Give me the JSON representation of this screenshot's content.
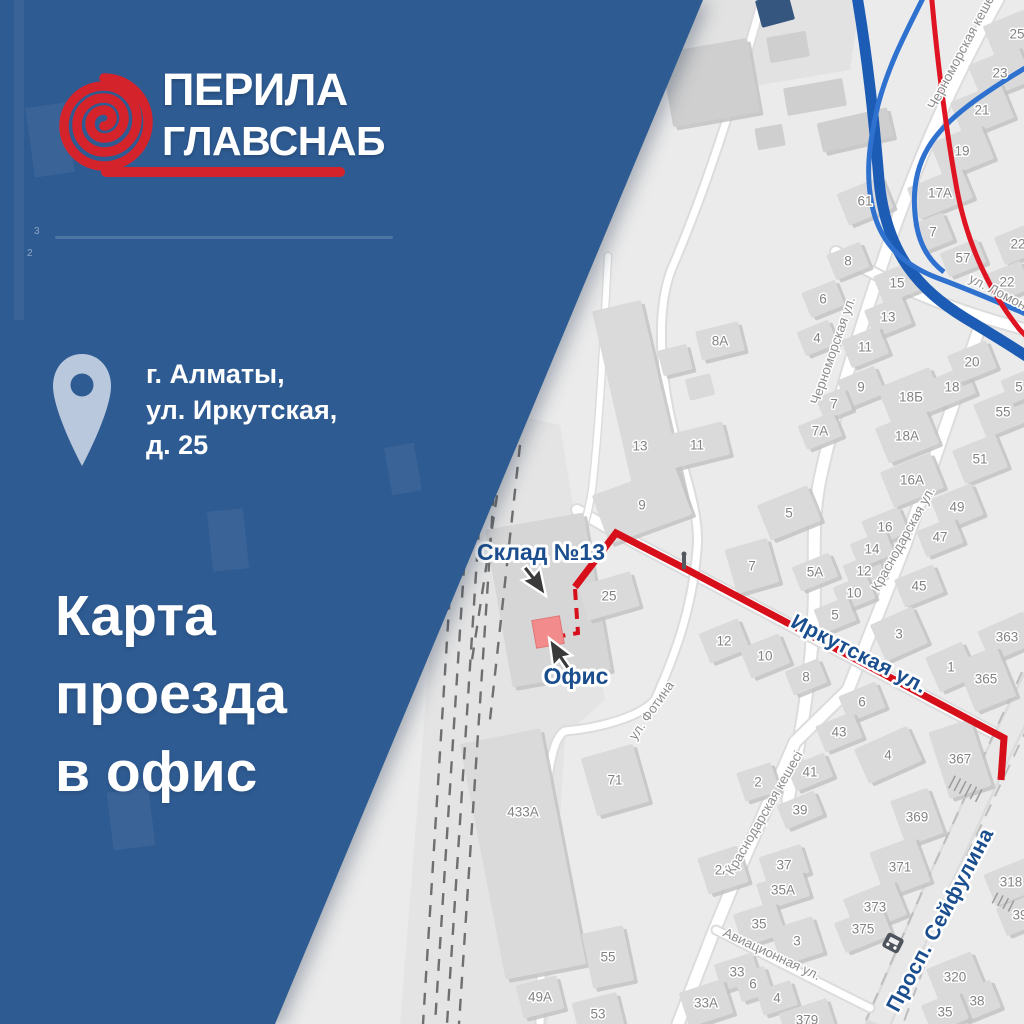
{
  "panel": {
    "brand": {
      "line1": "ПЕРИЛА",
      "line2": "ГЛАВСНАБ"
    },
    "address": {
      "lines": [
        "г. Алматы,",
        "ул. Иркутская,",
        "д. 25"
      ]
    },
    "title": {
      "lines": [
        "Карта",
        "проезда",
        "в офис"
      ]
    }
  },
  "map": {
    "callouts": {
      "warehouse": "Склад №13",
      "office": "Офис"
    },
    "ghost_labels": [
      {
        "t": "3"
      },
      {
        "t": "2"
      }
    ],
    "street_labels": [
      {
        "name": "Черноморская кешесі",
        "x": 967,
        "y": 50,
        "r": -62
      },
      {
        "name": "Черноморская ул.",
        "x": 837,
        "y": 352,
        "r": -71
      },
      {
        "name": "ул. Ломоносова",
        "x": 1012,
        "y": 304,
        "r": 27
      },
      {
        "name": "Краснодарская ул.",
        "x": 907,
        "y": 541,
        "r": -61
      },
      {
        "name": "Краснодарская кешесі",
        "x": 768,
        "y": 815,
        "r": -60
      },
      {
        "name": "ул. Фотина",
        "x": 655,
        "y": 713,
        "r": -55
      },
      {
        "name": "Авиационная ул.",
        "x": 770,
        "y": 958,
        "r": 25
      },
      {
        "name": "Иркутская ул.",
        "x": 856,
        "y": 660,
        "r": 27,
        "major": true
      },
      {
        "name": "Просп. Сейфулина",
        "x": 946,
        "y": 923,
        "r": -62,
        "major": true
      }
    ],
    "building_labels": [
      {
        "t": "25",
        "x": 1017,
        "y": 34,
        "w": 58,
        "h": 40
      },
      {
        "t": "23",
        "x": 1000,
        "y": 73,
        "w": 54,
        "h": 38
      },
      {
        "t": "21",
        "x": 982,
        "y": 110,
        "w": 54,
        "h": 38
      },
      {
        "t": "19",
        "x": 962,
        "y": 151,
        "w": 54,
        "h": 38
      },
      {
        "t": "17А",
        "x": 940,
        "y": 193,
        "w": 58,
        "h": 34
      },
      {
        "t": "7",
        "x": 933,
        "y": 232,
        "w": 32,
        "h": 30
      },
      {
        "t": "57",
        "x": 963,
        "y": 258,
        "w": 40,
        "h": 26
      },
      {
        "t": "22",
        "x": 1018,
        "y": 244,
        "w": 40,
        "h": 30
      },
      {
        "t": "22",
        "x": 1007,
        "y": 282,
        "w": 40,
        "h": 30
      },
      {
        "t": "61",
        "x": 865,
        "y": 201,
        "w": 48,
        "h": 34
      },
      {
        "t": "8",
        "x": 848,
        "y": 261,
        "w": 36,
        "h": 27
      },
      {
        "t": "6",
        "x": 823,
        "y": 299,
        "w": 36,
        "h": 27
      },
      {
        "t": "15",
        "x": 897,
        "y": 283,
        "w": 40,
        "h": 30
      },
      {
        "t": "13",
        "x": 888,
        "y": 317,
        "w": 40,
        "h": 30
      },
      {
        "t": "11",
        "x": 865,
        "y": 347,
        "w": 40,
        "h": 30
      },
      {
        "t": "9",
        "x": 861,
        "y": 387,
        "w": 40,
        "h": 30
      },
      {
        "t": "4",
        "x": 817,
        "y": 338,
        "w": 34,
        "h": 26
      },
      {
        "t": "7",
        "x": 834,
        "y": 404,
        "w": 30,
        "h": 24
      },
      {
        "t": "7А",
        "x": 820,
        "y": 431,
        "w": 38,
        "h": 26
      },
      {
        "t": "5",
        "x": 789,
        "y": 513,
        "w": 54,
        "h": 38
      },
      {
        "t": "8А",
        "x": 720,
        "y": 341,
        "w": 44,
        "h": 30,
        "r": -14
      },
      {
        "t": "13",
        "x": 640,
        "y": 446,
        "w": 50,
        "h": 210,
        "r": -13,
        "dy": -38
      },
      {
        "t": "11",
        "x": 697,
        "y": 445,
        "w": 60,
        "h": 34,
        "r": -14
      },
      {
        "t": "9",
        "x": 642,
        "y": 505,
        "w": 88,
        "h": 52,
        "r": -20
      },
      {
        "t": "25",
        "x": 609,
        "y": 596,
        "w": 54,
        "h": 36,
        "r": -16
      },
      {
        "t": "7",
        "x": 752,
        "y": 566,
        "w": 44,
        "h": 46,
        "r": -16
      },
      {
        "t": "5А",
        "x": 815,
        "y": 572,
        "w": 40,
        "h": 26
      },
      {
        "t": "12",
        "x": 724,
        "y": 641,
        "w": 42,
        "h": 32
      },
      {
        "t": "10",
        "x": 765,
        "y": 656,
        "w": 42,
        "h": 32
      },
      {
        "t": "8",
        "x": 806,
        "y": 677,
        "w": 36,
        "h": 26
      },
      {
        "t": "12",
        "x": 864,
        "y": 571,
        "w": 36,
        "h": 26
      },
      {
        "t": "10",
        "x": 854,
        "y": 593,
        "w": 36,
        "h": 26
      },
      {
        "t": "5",
        "x": 835,
        "y": 615,
        "w": 36,
        "h": 26
      },
      {
        "t": "45",
        "x": 919,
        "y": 586,
        "w": 42,
        "h": 30
      },
      {
        "t": "3",
        "x": 899,
        "y": 634,
        "w": 46,
        "h": 40,
        "r": -24
      },
      {
        "t": "1",
        "x": 951,
        "y": 667,
        "w": 40,
        "h": 38,
        "r": -24
      },
      {
        "t": "363",
        "x": 1007,
        "y": 637,
        "w": 50,
        "h": 34,
        "r": -24
      },
      {
        "t": "365",
        "x": 986,
        "y": 679,
        "w": 44,
        "h": 54,
        "r": -22
      },
      {
        "t": "6",
        "x": 862,
        "y": 702,
        "w": 40,
        "h": 28
      },
      {
        "t": "2",
        "x": 758,
        "y": 782,
        "w": 36,
        "h": 30,
        "r": -18
      },
      {
        "t": "43",
        "x": 839,
        "y": 732,
        "w": 40,
        "h": 28
      },
      {
        "t": "4",
        "x": 888,
        "y": 755,
        "w": 58,
        "h": 38,
        "r": -24
      },
      {
        "t": "367",
        "x": 960,
        "y": 759,
        "w": 44,
        "h": 70,
        "r": -18
      },
      {
        "t": "41",
        "x": 810,
        "y": 772,
        "w": 40,
        "h": 26
      },
      {
        "t": "39",
        "x": 800,
        "y": 810,
        "w": 40,
        "h": 26
      },
      {
        "t": "369",
        "x": 917,
        "y": 817,
        "w": 40,
        "h": 48,
        "r": -20
      },
      {
        "t": "371",
        "x": 900,
        "y": 867,
        "w": 48,
        "h": 48,
        "r": -20
      },
      {
        "t": "373",
        "x": 875,
        "y": 907,
        "w": 54,
        "h": 38,
        "r": -22
      },
      {
        "t": "375",
        "x": 863,
        "y": 929,
        "w": 50,
        "h": 32,
        "r": -22
      },
      {
        "t": "318",
        "x": 1011,
        "y": 882,
        "w": 46,
        "h": 34,
        "r": -22
      },
      {
        "t": "39",
        "x": 1020,
        "y": 915,
        "w": 40,
        "h": 30
      },
      {
        "t": "320",
        "x": 955,
        "y": 977,
        "w": 48,
        "h": 36,
        "r": -22
      },
      {
        "t": "38",
        "x": 977,
        "y": 1001,
        "w": 40,
        "h": 30
      },
      {
        "t": "35",
        "x": 945,
        "y": 1012,
        "w": 40,
        "h": 30
      },
      {
        "t": "2А",
        "x": 723,
        "y": 870,
        "w": 42,
        "h": 38,
        "r": -18
      },
      {
        "t": "37",
        "x": 784,
        "y": 865,
        "w": 44,
        "h": 30,
        "r": -18
      },
      {
        "t": "35А",
        "x": 783,
        "y": 890,
        "w": 48,
        "h": 28,
        "r": -18
      },
      {
        "t": "35",
        "x": 759,
        "y": 924,
        "w": 44,
        "h": 34,
        "r": -18
      },
      {
        "t": "3",
        "x": 797,
        "y": 941,
        "w": 44,
        "h": 38,
        "r": -18
      },
      {
        "t": "33",
        "x": 737,
        "y": 972,
        "w": 40,
        "h": 28,
        "r": -18
      },
      {
        "t": "6",
        "x": 753,
        "y": 984,
        "w": 32,
        "h": 28,
        "r": -18
      },
      {
        "t": "4",
        "x": 777,
        "y": 998,
        "w": 36,
        "h": 26,
        "r": -18
      },
      {
        "t": "33А",
        "x": 706,
        "y": 1003,
        "w": 46,
        "h": 36,
        "r": -18
      },
      {
        "t": "379",
        "x": 807,
        "y": 1020,
        "w": 50,
        "h": 30,
        "r": -18
      },
      {
        "t": "71",
        "x": 615,
        "y": 780,
        "w": 54,
        "h": 60,
        "r": -16
      },
      {
        "t": "433А",
        "x": 523,
        "y": 812,
        "w": 82,
        "h": 240,
        "r": -11,
        "dy": 42
      },
      {
        "t": "55",
        "x": 608,
        "y": 957,
        "w": 42,
        "h": 56,
        "r": -12
      },
      {
        "t": "49А",
        "x": 540,
        "y": 997,
        "w": 42,
        "h": 34,
        "r": -14
      },
      {
        "t": "53",
        "x": 598,
        "y": 1014,
        "w": 46,
        "h": 34,
        "r": -14
      },
      {
        "t": "55",
        "x": 1003,
        "y": 412,
        "w": 50,
        "h": 36
      },
      {
        "t": "51",
        "x": 980,
        "y": 459,
        "w": 46,
        "h": 36
      },
      {
        "t": "49",
        "x": 957,
        "y": 507,
        "w": 44,
        "h": 34
      },
      {
        "t": "47",
        "x": 940,
        "y": 537,
        "w": 40,
        "h": 28
      },
      {
        "t": "16",
        "x": 885,
        "y": 527,
        "w": 40,
        "h": 28
      },
      {
        "t": "14",
        "x": 872,
        "y": 549,
        "w": 38,
        "h": 26
      },
      {
        "t": "18Б",
        "x": 911,
        "y": 397,
        "w": 56,
        "h": 42
      },
      {
        "t": "18",
        "x": 952,
        "y": 387,
        "w": 40,
        "h": 30
      },
      {
        "t": "20",
        "x": 972,
        "y": 362,
        "w": 42,
        "h": 30
      },
      {
        "t": "18А",
        "x": 907,
        "y": 436,
        "w": 54,
        "h": 38
      },
      {
        "t": "16А",
        "x": 912,
        "y": 480,
        "w": 54,
        "h": 38
      },
      {
        "t": "5",
        "x": 1019,
        "y": 387,
        "w": 30,
        "h": 26
      }
    ]
  },
  "colors": {
    "map_bg": "#ebebeb",
    "building_fill": "#dadada",
    "panel_blue": "#2e5b92",
    "logo_red": "#d5232c",
    "route_red": "#d70f1b",
    "label_blue": "#1b4e8e",
    "curve_blue_thick": "#1d5cb4",
    "curve_blue_thin": "#2f71cf",
    "curve_red": "#e01523",
    "office_pink": "#f28b8b",
    "pin_fill": "#b9c8dd"
  }
}
